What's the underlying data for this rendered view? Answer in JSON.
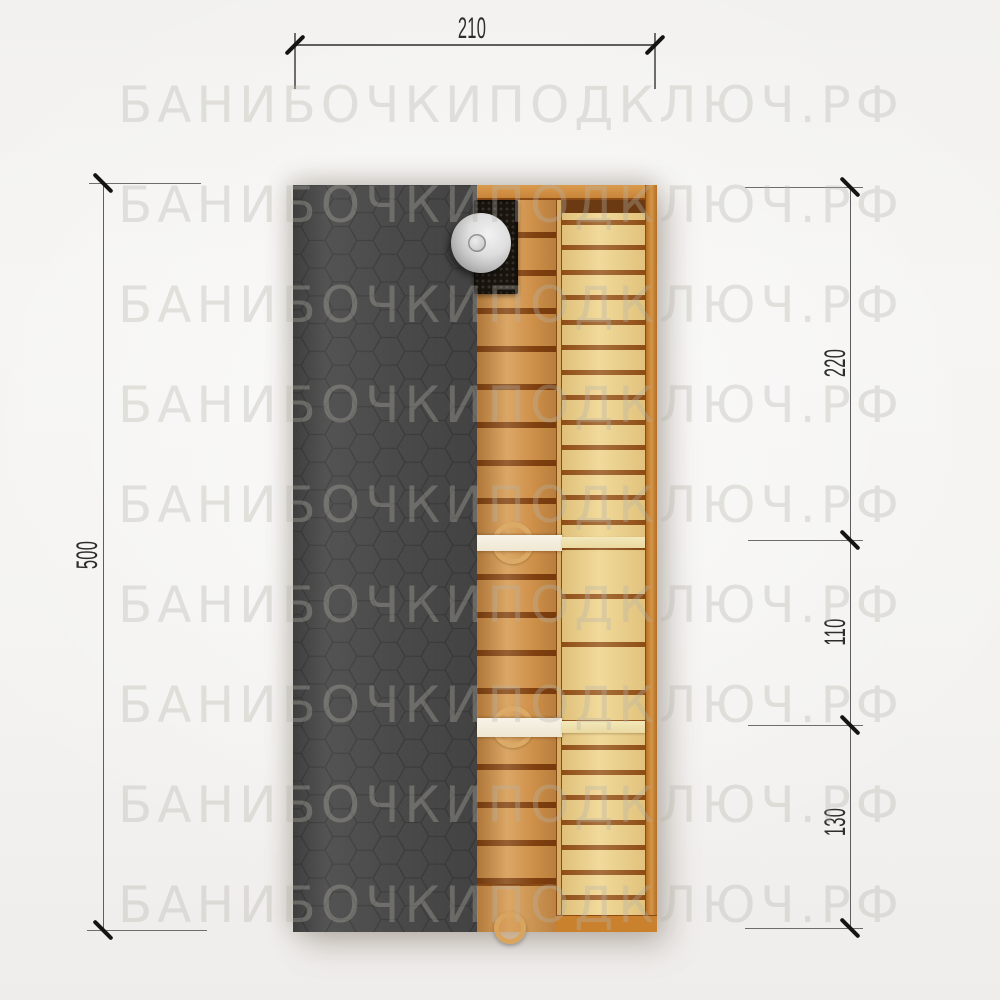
{
  "watermark": {
    "text": "БАНИБОЧКИПОДКЛЮЧ.РФ",
    "row_count": 9,
    "color": "#b6b2ab"
  },
  "dimensions": {
    "top": {
      "label": "210",
      "orientation": "horizontal"
    },
    "left": {
      "label": "500",
      "orientation": "vertical"
    },
    "right": [
      {
        "label": "220"
      },
      {
        "label": "110"
      },
      {
        "label": "130"
      }
    ],
    "line_color": "#5e5e5e",
    "tick_color": "#141414",
    "text_color": "#2d2d2d"
  },
  "plan": {
    "type": "barrel-sauna top view plan drawing",
    "roof": {
      "color": "#4a4a4a",
      "pattern": "hexagon-shingles",
      "pattern_line_color": "#3d3d3d"
    },
    "stove": {
      "body_color": "#1a140e",
      "chimney_color": "#d8d8d8"
    },
    "wood": {
      "bench_color": "#d2954e",
      "floor_color": "#edd28b",
      "frame_color": "#c9812e",
      "gap_color": "#7c3d0e"
    },
    "partitions": {
      "wall_color": "#f3eee1",
      "right_strip_color": "#efe2ae",
      "handle_color": "#dcaa67"
    },
    "background_color": "#f4f3f1"
  }
}
